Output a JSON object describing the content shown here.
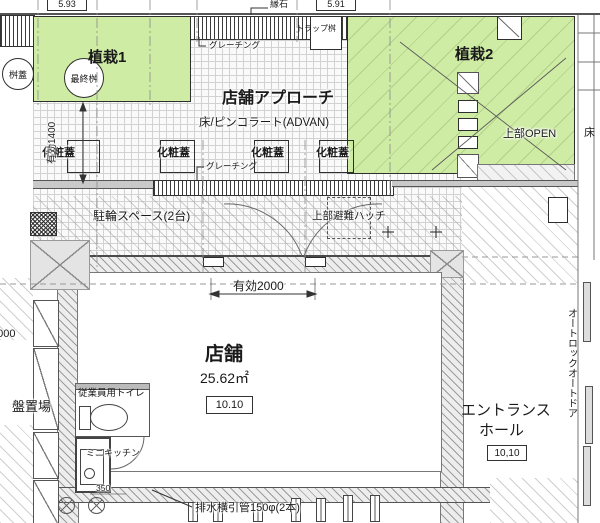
{
  "elevations": {
    "left": "5.93",
    "right": "5.91"
  },
  "labels": {
    "curb": "縁石",
    "planting1": "植栽1",
    "planting2": "植栽2",
    "masu_cover": "桝蓋",
    "final_masu": "最終桝",
    "trap_masu": "トラップ桝",
    "grating1": "グレーチング",
    "grating2": "グレーチング",
    "approach_title": "店舗アプローチ",
    "approach_floor": "床/ピンコラート(ADVAN)",
    "cover1": "化粧蓋",
    "cover2": "化粧蓋",
    "cover3": "化粧蓋",
    "cover4": "化粧蓋",
    "bike_space": "駐輪スペース(2台)",
    "hatch_above": "上部避難ハッチ",
    "open_above": "上部OPEN",
    "floor_right": "床",
    "store": "店舗",
    "store_area": "25.62㎡",
    "store_code": "10.10",
    "entrance1": "エントランス",
    "entrance2": "ホール",
    "entrance_code": "10,10",
    "auto_door": "オートロックオートドア",
    "panel_yard": "盤置場",
    "staff_toilet": "従業員用トイレ",
    "mini_kitchen": "ミニキッチン",
    "drain_note": "排水横引管150φ(2本)"
  },
  "dimensions": {
    "approach_depth": "有効1400",
    "door_width": "有効2000",
    "left_width": "2000",
    "kitchen_width": "350"
  },
  "colors": {
    "planting": "#cfeca5",
    "wall": "#c9c9c9",
    "line": "#333333"
  }
}
